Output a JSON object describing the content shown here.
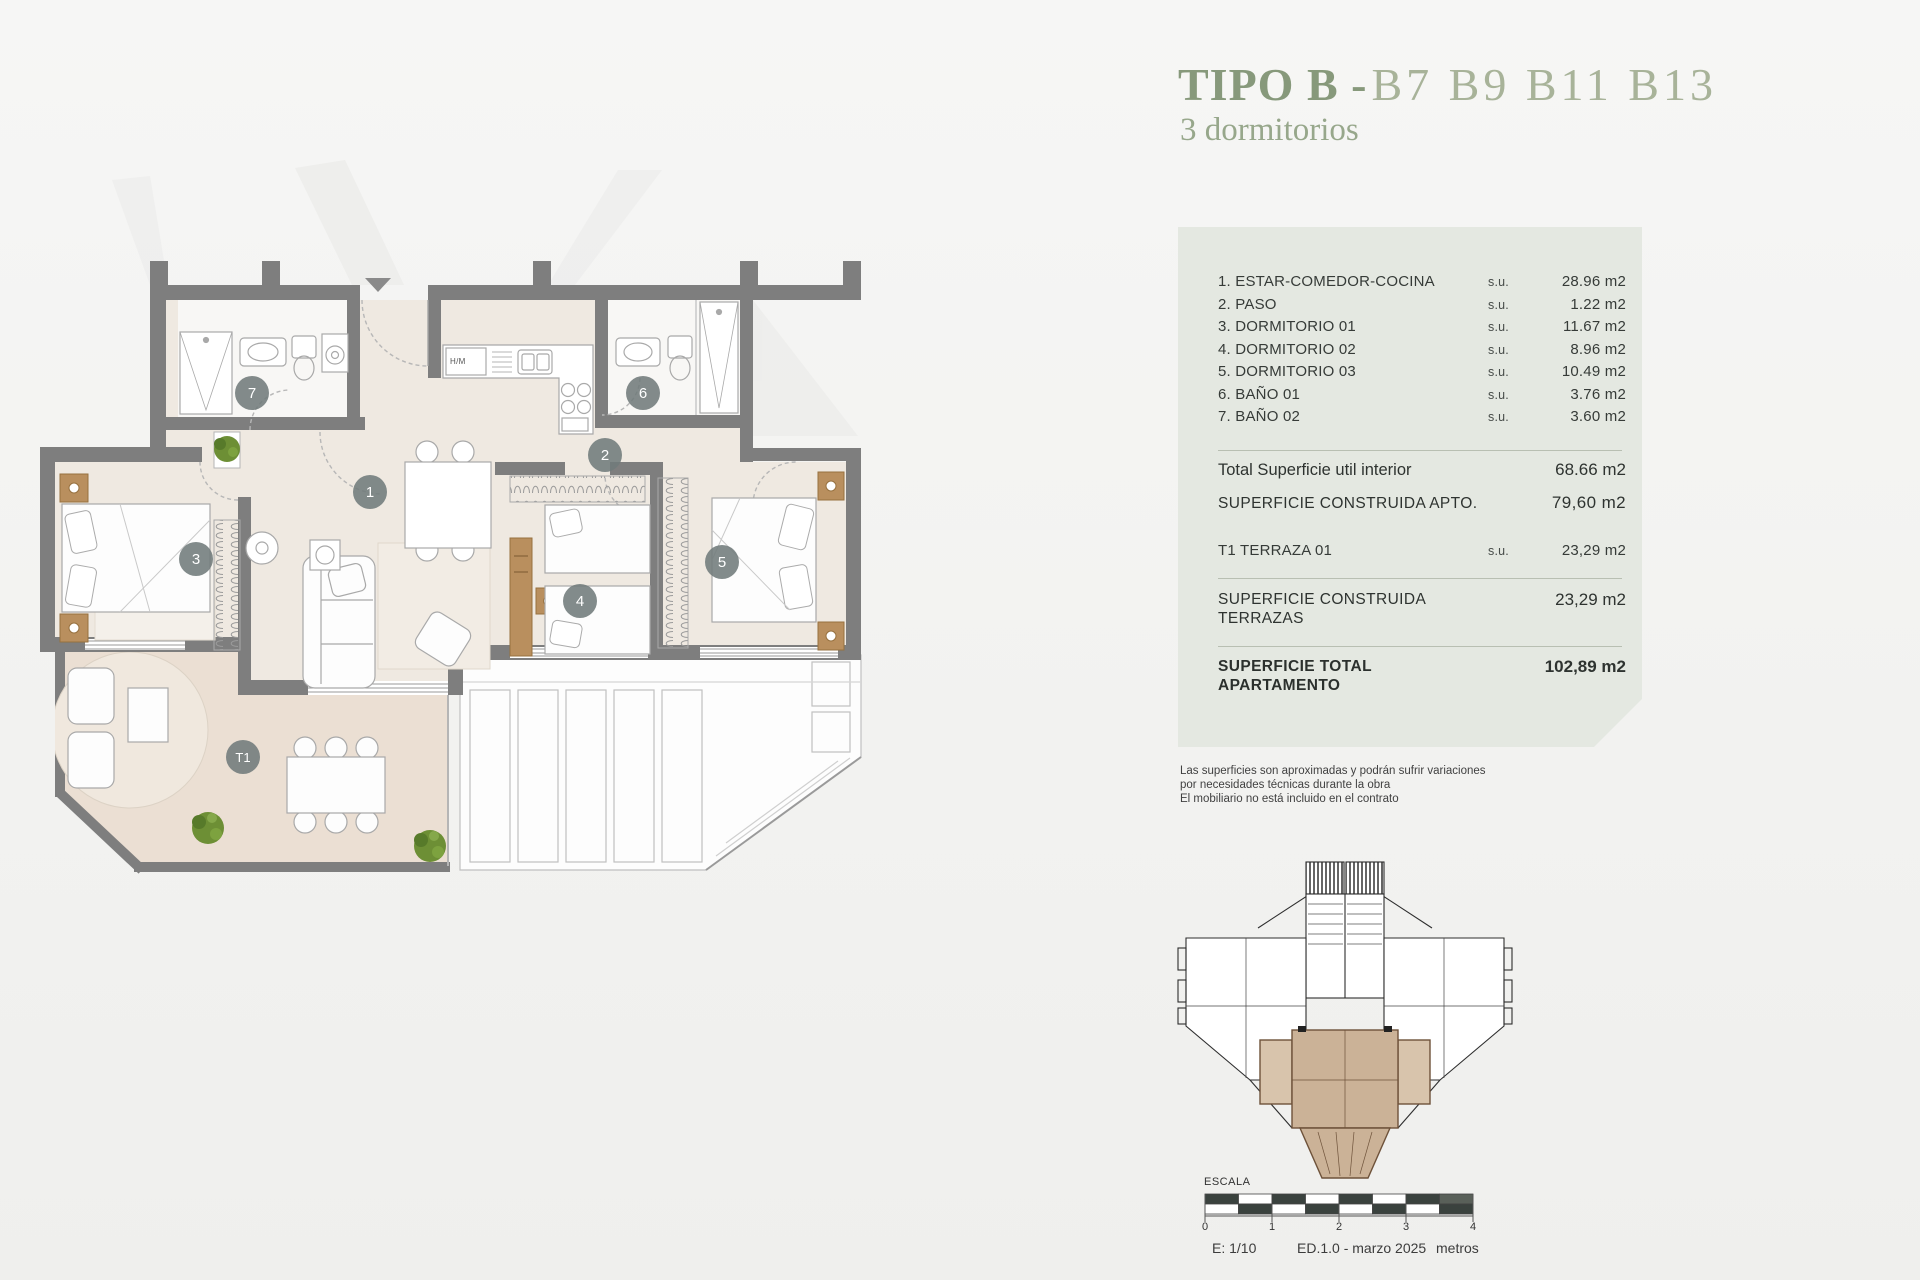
{
  "title": {
    "tipo": "TIPO B -",
    "units": "B7 B9 B11 B13",
    "subtitle": "3 dormitorios"
  },
  "panel": {
    "rooms": [
      {
        "label": "1. ESTAR-COMEDOR-COCINA",
        "su": "s.u.",
        "value": "28.96 m2"
      },
      {
        "label": "2. PASO",
        "su": "s.u.",
        "value": "1.22 m2"
      },
      {
        "label": "3. DORMITORIO 01",
        "su": "s.u.",
        "value": "11.67 m2"
      },
      {
        "label": "4. DORMITORIO 02",
        "su": "s.u.",
        "value": "8.96 m2"
      },
      {
        "label": "5. DORMITORIO 03",
        "su": "s.u.",
        "value": "10.49 m2"
      },
      {
        "label": "6. BAÑO 01",
        "su": "s.u.",
        "value": "3.76 m2"
      },
      {
        "label": "7. BAÑO 02",
        "su": "s.u.",
        "value": "3.60 m2"
      }
    ],
    "total_interior": {
      "label": "Total Superficie util interior",
      "value": "68.66 m2"
    },
    "construida_apto": {
      "label": "SUPERFICIE CONSTRUIDA APTO.",
      "value": "79,60 m2"
    },
    "terraza": {
      "label": "T1 TERRAZA 01",
      "su": "s.u.",
      "value": "23,29 m2"
    },
    "construida_terrazas": {
      "label": "SUPERFICIE CONSTRUIDA TERRAZAS",
      "value": "23,29 m2"
    },
    "total": {
      "label": "SUPERFICIE TOTAL APARTAMENTO",
      "value": "102,89 m2"
    }
  },
  "disclaimer": {
    "line1": "Las superficies son aproximadas y podrán sufrir variaciones",
    "line2": "por necesidades técnicas durante la obra",
    "line3": "El mobiliario no está incluido en el contrato"
  },
  "scale": {
    "label": "ESCALA",
    "ticks": [
      "0",
      "1",
      "2",
      "3",
      "4"
    ],
    "ratio": "E: 1/10",
    "edition": "ED.1.0 - marzo 2025",
    "unit": "metros"
  },
  "plan": {
    "badges": [
      "1",
      "2",
      "3",
      "4",
      "5",
      "6",
      "7",
      "T1"
    ],
    "appliance": "H/M"
  },
  "colors": {
    "title_green": "#87997b",
    "units_green": "#a8b399",
    "subtitle_green": "#97a78b",
    "panel_bg": "#e4e8e1",
    "accent_orange": "#c9996b",
    "wall_gray": "#7e7e7e",
    "floor_beige": "#efe9e1",
    "terrace_beige": "#ebdfd3",
    "badge_gray": "#717b7b",
    "wood_tan": "#b98f5e",
    "keyplan_highlight": "#cbb297"
  }
}
